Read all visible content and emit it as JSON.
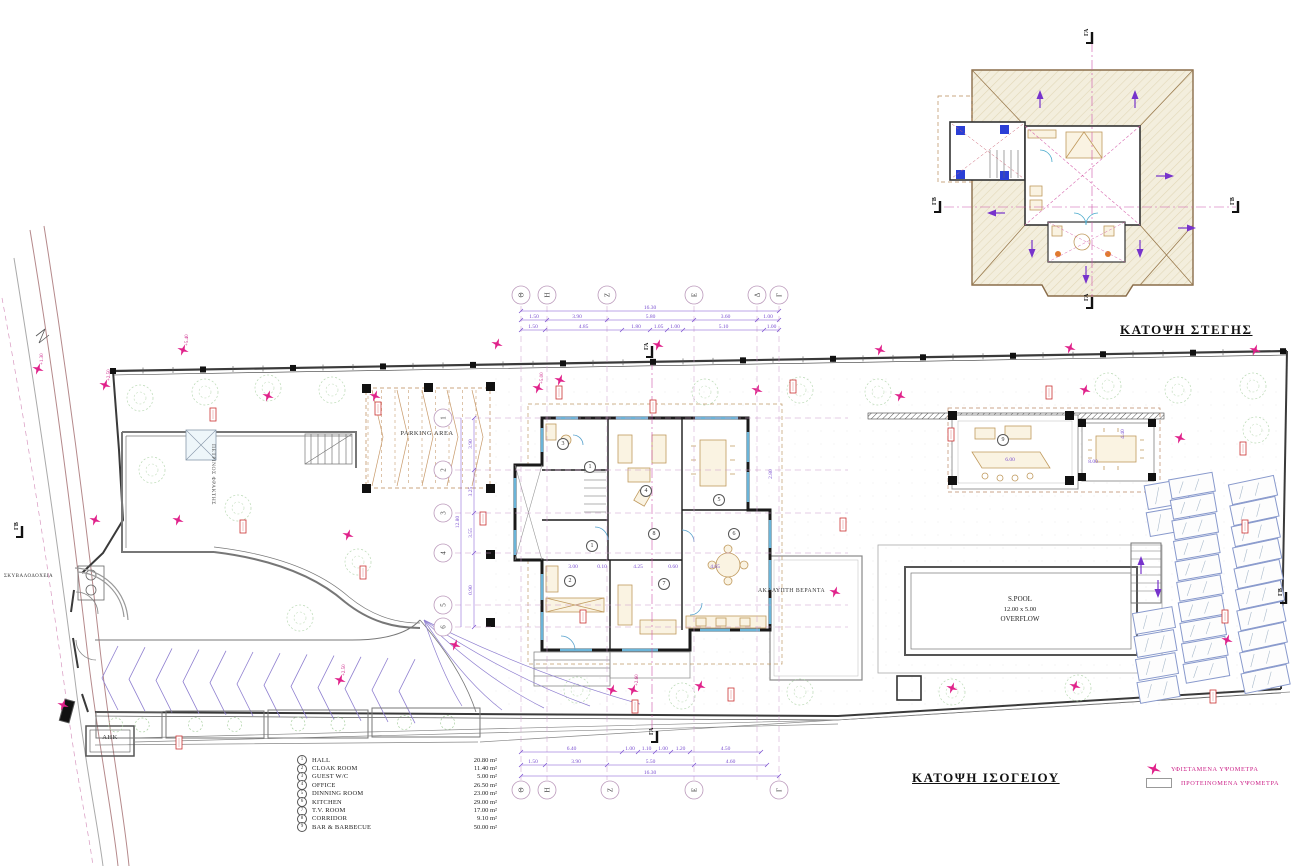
{
  "titles": {
    "roof_plan": "ΚΑΤΟΨΗ ΣΤΕΓΗΣ",
    "ground_plan": "ΚΑΤΟΨΗ ΙΣΟΓΕΙΟΥ"
  },
  "room_schedule": [
    {
      "num": "1",
      "name": "HALL",
      "area": "20.80 m²"
    },
    {
      "num": "2",
      "name": "CLOAK ROOM",
      "area": "11.40 m²"
    },
    {
      "num": "3",
      "name": "GUEST W/C",
      "area": "5.00 m²"
    },
    {
      "num": "4",
      "name": "OFFICE",
      "area": "26.50 m²"
    },
    {
      "num": "5",
      "name": "DINNING ROOM",
      "area": "23.00 m²"
    },
    {
      "num": "6",
      "name": "KITCHEN",
      "area": "29.00 m²"
    },
    {
      "num": "7",
      "name": "T.V. ROOM",
      "area": "17.00 m²"
    },
    {
      "num": "8",
      "name": "CORRIDOR",
      "area": "9.10 m²"
    },
    {
      "num": "9",
      "name": "BAR & BARBECUE",
      "area": "50.00 m²"
    }
  ],
  "legend": {
    "existing": "ΥΦΙΣΤΑΜΕΝΑ ΥΨΟΜΕΤΡΑ",
    "proposed": "ΠΡΟΤΕΙΝΟΜΕΝΑ ΥΨΟΜΕΤΡΑ"
  },
  "labels": {
    "parking": "PARKING AREA",
    "veranda": "ΑΚΑΛΥΠΤΗ ΒΕΡΑΝΤΑ",
    "pool": [
      "S.POOL",
      "12.00 x 5.00",
      "OVERFLOW"
    ],
    "stone_fence": "ΠΕΤΡΙΝΟΣ ΦΡΑΚΤΗΣ",
    "bins": "ΣΚΥΒΑΛΟΔΟΧΕΙΑ",
    "ahk": "ΑΗΚ"
  },
  "sections": {
    "ga": "ΓΑ",
    "gb": "ΓΒ"
  },
  "grid": {
    "top": [
      {
        "l": "Θ",
        "x": 521
      },
      {
        "l": "Η",
        "x": 547
      },
      {
        "l": "Ζ",
        "x": 607
      },
      {
        "l": "Ε",
        "x": 694
      },
      {
        "l": "Δ",
        "x": 757
      },
      {
        "l": "Γ",
        "x": 779
      }
    ],
    "bottom": [
      {
        "l": "Θ",
        "x": 521
      },
      {
        "l": "Η",
        "x": 547
      },
      {
        "l": "Ζ",
        "x": 610
      },
      {
        "l": "Ε",
        "x": 694
      },
      {
        "l": "Γ",
        "x": 779
      }
    ],
    "left": [
      {
        "l": "1",
        "y": 418
      },
      {
        "l": "2",
        "y": 470
      },
      {
        "l": "3",
        "y": 513
      },
      {
        "l": "4",
        "y": 553
      },
      {
        "l": "5",
        "y": 605
      },
      {
        "l": "6",
        "y": 627
      }
    ]
  },
  "dim_rows": [
    {
      "y": 311,
      "ticks": [
        521,
        779
      ],
      "labels": [
        "16.30"
      ]
    },
    {
      "y": 320,
      "ticks": [
        521,
        547,
        607,
        694,
        757,
        779
      ],
      "labels": [
        "1.50",
        "3.90",
        "5.80",
        "3.60",
        "1.00"
      ]
    },
    {
      "y": 330,
      "ticks": [
        521,
        545,
        622,
        650,
        667,
        683,
        764,
        779
      ],
      "labels": [
        "1.50",
        "4.85",
        "1.80",
        "1.05",
        "1.00",
        "5.10",
        "1.00"
      ]
    },
    {
      "y": 752,
      "ticks": [
        521,
        622,
        638,
        655,
        671,
        690,
        761
      ],
      "labels": [
        "6.40",
        "1.00",
        "1.10",
        "1.00",
        "1.20",
        "4.50"
      ]
    },
    {
      "y": 765,
      "ticks": [
        521,
        545,
        607,
        694,
        767
      ],
      "labels": [
        "1.50",
        "3.90",
        "5.50",
        "4.60"
      ]
    },
    {
      "y": 776,
      "ticks": [
        521,
        779
      ],
      "labels": [
        "16.30"
      ]
    }
  ],
  "left_dims": {
    "x1": 461,
    "x2": 474,
    "total": "12.80",
    "ticks": [
      418,
      470,
      513,
      553,
      627
    ],
    "segs": [
      "3.90",
      "3.25",
      "3.55",
      "0.90"
    ]
  },
  "dim_texts": [
    {
      "t": "3.00",
      "x": 573,
      "y": 568
    },
    {
      "t": "0.10",
      "x": 602,
      "y": 568
    },
    {
      "t": "4.25",
      "x": 638,
      "y": 568
    },
    {
      "t": "0.60",
      "x": 673,
      "y": 568
    },
    {
      "t": "4.65",
      "x": 715,
      "y": 568
    },
    {
      "t": "6.00",
      "x": 1010,
      "y": 461
    },
    {
      "t": "8.00",
      "x": 1093,
      "y": 463
    },
    {
      "t": "4.40",
      "x": 1124,
      "y": 434,
      "rot": -90
    },
    {
      "t": "2.80",
      "x": 772,
      "y": 474,
      "rot": -90
    }
  ],
  "room_labels": [
    [
      "3",
      562,
      443
    ],
    [
      "1",
      589,
      466
    ],
    [
      "4",
      645,
      490
    ],
    [
      "5",
      718,
      499
    ],
    [
      "8",
      653,
      533
    ],
    [
      "6",
      733,
      533
    ],
    [
      "1",
      591,
      545
    ],
    [
      "2",
      569,
      580
    ],
    [
      "7",
      663,
      583
    ],
    [
      "9",
      1002,
      439
    ]
  ],
  "labeled_stars": [
    {
      "x": 105,
      "y": 385,
      "v": "+2.50"
    },
    {
      "x": 183,
      "y": 350,
      "v": "+5.40"
    },
    {
      "x": 538,
      "y": 388,
      "v": "+5.00"
    },
    {
      "x": 38,
      "y": 369,
      "v": "+1.30"
    },
    {
      "x": 340,
      "y": 680,
      "v": "+2.50"
    },
    {
      "x": 633,
      "y": 690,
      "v": "+2.60"
    }
  ],
  "render": {
    "trees": [
      [
        140,
        398
      ],
      [
        205,
        392
      ],
      [
        268,
        388
      ],
      [
        332,
        390
      ],
      [
        705,
        392
      ],
      [
        800,
        390
      ],
      [
        878,
        392
      ],
      [
        1108,
        386
      ],
      [
        1178,
        390
      ],
      [
        1253,
        386
      ],
      [
        1256,
        430
      ],
      [
        152,
        470
      ],
      [
        238,
        508
      ],
      [
        358,
        562
      ],
      [
        300,
        618
      ],
      [
        577,
        690
      ],
      [
        682,
        696
      ],
      [
        800,
        692
      ],
      [
        952,
        692
      ],
      [
        1078,
        688
      ]
    ],
    "stars": [
      [
        268,
        396
      ],
      [
        375,
        396
      ],
      [
        497,
        344
      ],
      [
        560,
        380
      ],
      [
        658,
        345
      ],
      [
        757,
        390
      ],
      [
        880,
        350
      ],
      [
        900,
        396
      ],
      [
        1070,
        348
      ],
      [
        1085,
        390
      ],
      [
        1255,
        350
      ],
      [
        1180,
        438
      ],
      [
        95,
        520
      ],
      [
        178,
        520
      ],
      [
        348,
        535
      ],
      [
        63,
        705
      ],
      [
        455,
        645
      ],
      [
        612,
        690
      ],
      [
        700,
        686
      ],
      [
        835,
        592
      ],
      [
        952,
        688
      ],
      [
        1075,
        686
      ],
      [
        1227,
        640
      ]
    ],
    "red_boxes": [
      [
        210,
        408
      ],
      [
        375,
        402
      ],
      [
        556,
        386
      ],
      [
        650,
        400
      ],
      [
        790,
        380
      ],
      [
        948,
        428
      ],
      [
        1046,
        386
      ],
      [
        1240,
        442
      ],
      [
        240,
        520
      ],
      [
        360,
        566
      ],
      [
        480,
        512
      ],
      [
        580,
        610
      ],
      [
        728,
        688
      ],
      [
        840,
        518
      ],
      [
        1222,
        610
      ],
      [
        632,
        700
      ],
      [
        176,
        736
      ],
      [
        1242,
        520
      ],
      [
        1210,
        690
      ]
    ],
    "roof_arrows": [
      [
        1040,
        96,
        0
      ],
      [
        1135,
        96,
        0
      ],
      [
        993,
        213,
        270
      ],
      [
        1168,
        176,
        90
      ],
      [
        1190,
        228,
        90
      ],
      [
        1032,
        252,
        180
      ],
      [
        1140,
        252,
        180
      ],
      [
        1086,
        278,
        180
      ],
      [
        1141,
        562,
        0
      ],
      [
        1158,
        592,
        180
      ]
    ],
    "panels": [
      {
        "x": 1146,
        "y": 482,
        "n": 2,
        "sy": 27,
        "sx": 2,
        "w": 42,
        "h": 24,
        "rot": -10
      },
      {
        "x": 1134,
        "y": 610,
        "n": 4,
        "sy": 23,
        "sx": 1.5,
        "w": 40,
        "h": 21,
        "rot": -10
      },
      {
        "x": 1170,
        "y": 476,
        "n": 10,
        "sy": 20.5,
        "sx": 1.6,
        "w": 44,
        "h": 19,
        "rot": -10
      },
      {
        "x": 1230,
        "y": 480,
        "n": 10,
        "sy": 21,
        "sx": 1.4,
        "w": 46,
        "h": 20,
        "rot": -12
      }
    ],
    "planters": [
      [
        96,
        712,
        66,
        26
      ],
      [
        166,
        711,
        98,
        27
      ],
      [
        268,
        710,
        100,
        28
      ],
      [
        372,
        708,
        108,
        29
      ]
    ],
    "section_markers": [
      {
        "t": "ga",
        "x": 652,
        "y": 352
      },
      {
        "t": "ga",
        "x": 657,
        "y": 737
      },
      {
        "t": "gb",
        "x": 22,
        "y": 532
      },
      {
        "t": "gb",
        "x": 1286,
        "y": 598
      },
      {
        "t": "ga",
        "x": 1092,
        "y": 38
      },
      {
        "t": "ga",
        "x": 1092,
        "y": 303
      },
      {
        "t": "gb",
        "x": 940,
        "y": 207
      },
      {
        "t": "gb",
        "x": 1238,
        "y": 207
      }
    ]
  },
  "colors": {
    "magenta": "#e0218a",
    "dim_purple": "#7a4fd0",
    "roof_tan": "#f3eedd",
    "roof_edge": "#8a6d4a",
    "wall_black": "#1a1a1a",
    "window_cyan": "#6ab4d8",
    "furniture_tan": "#c09a5e",
    "tree_green": "#a8cfa0",
    "red_mark": "#cc3333"
  }
}
